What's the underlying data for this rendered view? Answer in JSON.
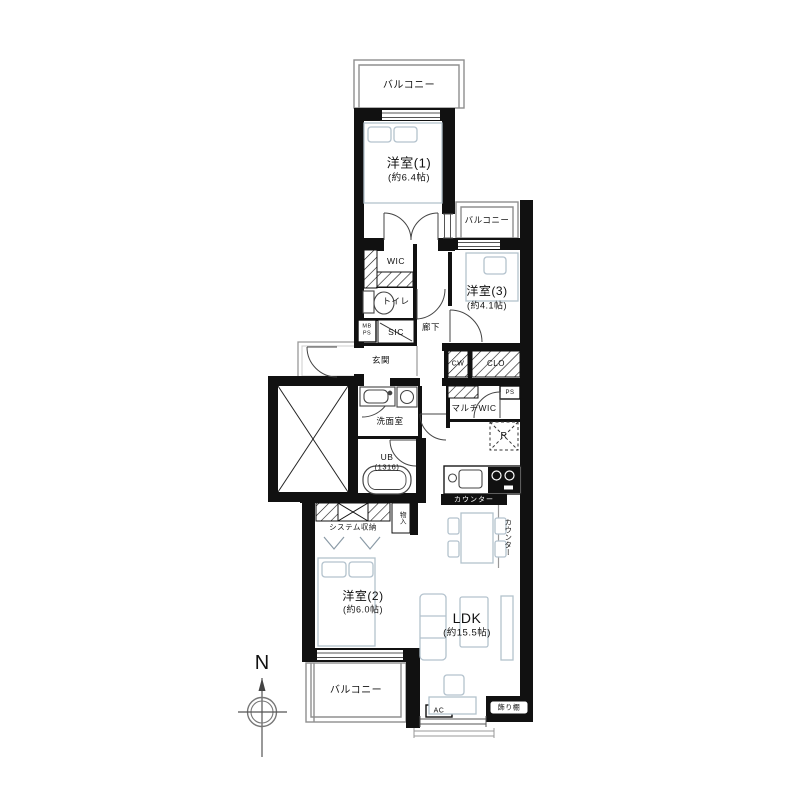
{
  "floorplan": {
    "description": "apartment floor plan 3LDK",
    "labels": {
      "balcony_top": "バルコニー",
      "room1": "洋室(1)",
      "room1_size": "(約6.4帖)",
      "balcony_right": "バルコニー",
      "room3": "洋室(3)",
      "room3_size": "(約4.1帖)",
      "wic": "WIC",
      "toilet": "トイレ",
      "mb": "MB",
      "ps": "PS",
      "sic": "SIC",
      "hallway": "廊下",
      "entrance": "玄関",
      "cw": "CW",
      "clo": "CLO",
      "ps2": "PS",
      "multi_wic": "マルチWIC",
      "refrigerator": "R",
      "counter_kitchen": "カウンター",
      "counter_side": "カウンター",
      "washroom": "洗面室",
      "ub": "UB",
      "ub_size": "(1316)",
      "system_storage": "システム収納",
      "storage": "物入",
      "room2": "洋室(2)",
      "room2_size": "(約6.0帖)",
      "ldk": "LDK",
      "ldk_size": "(約15.5帖)",
      "balcony_bottom": "バルコニー",
      "ac": "AC",
      "display_shelf": "飾り棚",
      "north": "N"
    },
    "colors": {
      "wall": "#111111",
      "furniture": "#b3c2cd",
      "balcony_line": "#8f8f8f",
      "counter_bar": "#111111",
      "counter_text": "#ffffff"
    }
  }
}
